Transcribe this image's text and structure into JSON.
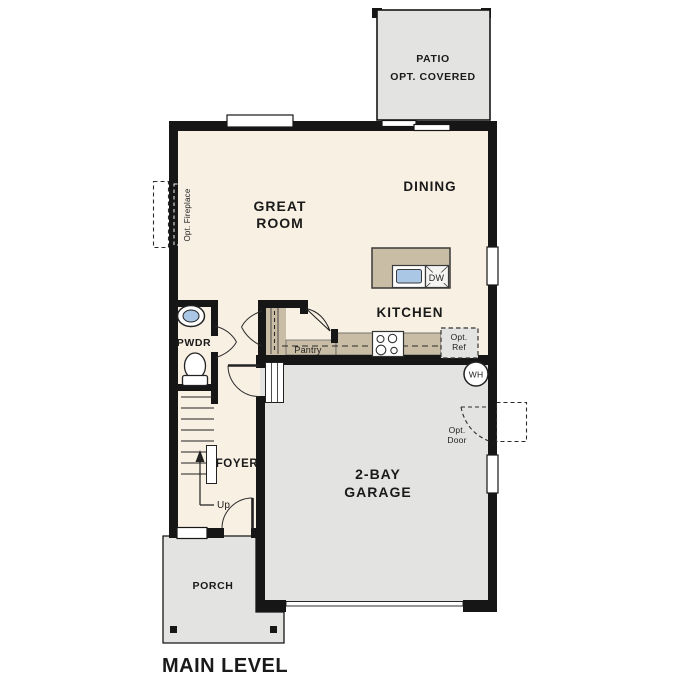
{
  "plan": {
    "title": "MAIN LEVEL",
    "rooms": {
      "patio": {
        "line1": "PATIO",
        "line2": "OPT. COVERED"
      },
      "great_room": {
        "line1": "GREAT",
        "line2": "ROOM"
      },
      "dining": {
        "label": "DINING"
      },
      "kitchen": {
        "label": "KITCHEN"
      },
      "pwdr": {
        "label": "PWDR"
      },
      "pantry": {
        "label": "Pantry"
      },
      "foyer": {
        "label": "FOYER"
      },
      "garage": {
        "line1": "2-BAY",
        "line2": "GARAGE"
      },
      "porch": {
        "label": "PORCH"
      }
    },
    "annotations": {
      "opt_fireplace": "Opt. Fireplace",
      "opt_ref": {
        "line1": "Opt.",
        "line2": "Ref"
      },
      "opt_door": {
        "line1": "Opt.",
        "line2": "Door"
      },
      "up": "Up",
      "wh": "WH",
      "dw": "DW"
    },
    "colors": {
      "floor_cream": "#f8f0e3",
      "hardscape_gray": "#e3e3e1",
      "cabinet_tan": "#cabda5",
      "fixture_blue": "#aac8e6",
      "wall_black": "#161616"
    }
  }
}
